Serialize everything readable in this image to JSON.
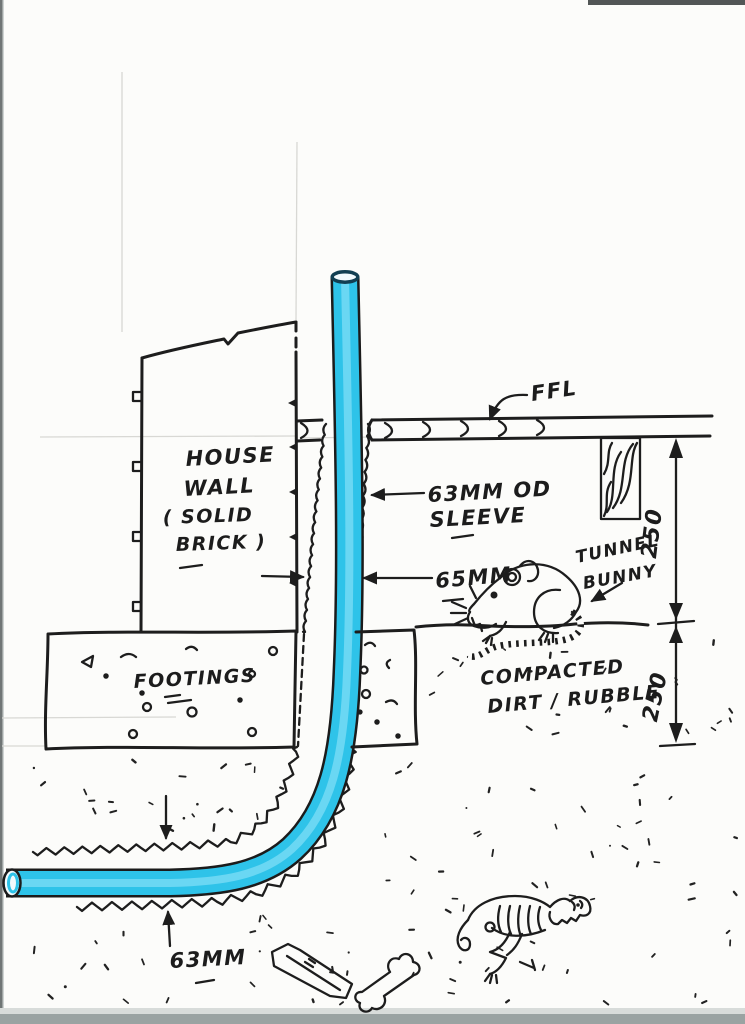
{
  "diagram": {
    "labels": {
      "house_wall": [
        "HOUSE",
        "WALL",
        "( SOLID",
        "BRICK )"
      ],
      "ffl": "FFL",
      "sleeve": [
        "63MM OD",
        "SLEEVE"
      ],
      "wall_gap": "65MM",
      "tunnel_bunny": [
        "TUNNEL",
        "BUNNY"
      ],
      "footings": "FOOTINGS",
      "compacted": [
        "COMPACTED",
        "DIRT / RUBBLE"
      ],
      "dim_above_ground": "250",
      "dim_below_ground": "250",
      "pipe_od": "63MM"
    },
    "colors": {
      "ink": "#1d1d1d",
      "pipe_fill": "#2ec3e9",
      "pipe_highlight": "#74daf4",
      "pipe_opening": "#f2fafd",
      "paper": "#fcfcfa"
    }
  }
}
